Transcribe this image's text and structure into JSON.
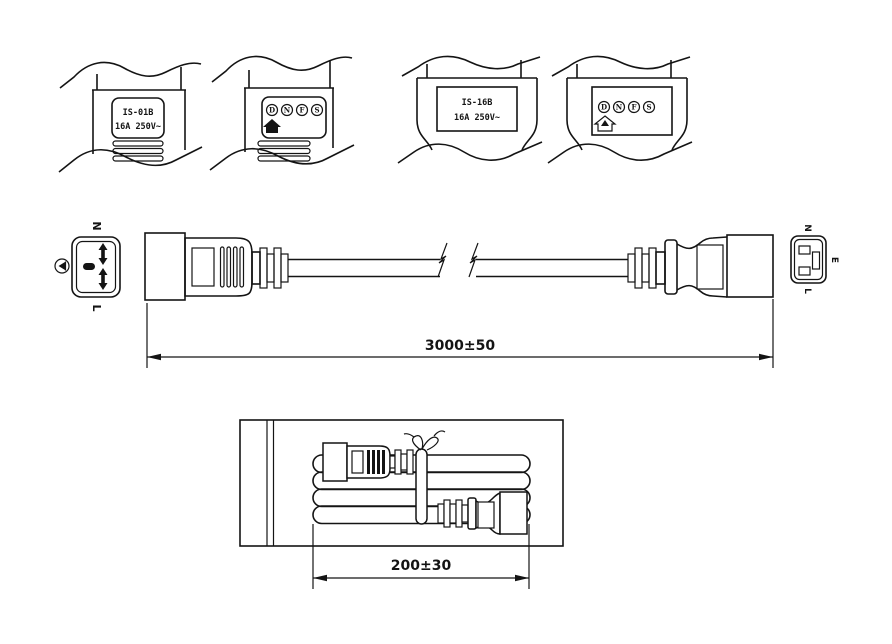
{
  "drawing": {
    "background_color": "#ffffff",
    "line_color": "#141414",
    "type": "power-cord-technical-drawing"
  },
  "detail_views": {
    "c20_label": {
      "model": "IS-01B",
      "rating": "16A 250V~"
    },
    "c20_certs": {
      "marks": [
        "D",
        "N",
        "F",
        "S"
      ],
      "icon": "house-mark"
    },
    "c19_label": {
      "model": "IS-16B",
      "rating": "16A 250V~"
    },
    "c19_certs": {
      "marks": [
        "D",
        "N",
        "F",
        "S"
      ],
      "icon": "house-crown-mark"
    }
  },
  "plug_face": {
    "top": "N",
    "bottom": "L",
    "earth_icon": "protective-earth"
  },
  "connector_face": {
    "top": "N",
    "right": "E",
    "bottom": "L"
  },
  "dimensions": {
    "cable_length": "3000±50",
    "coil_width": "200±30"
  }
}
